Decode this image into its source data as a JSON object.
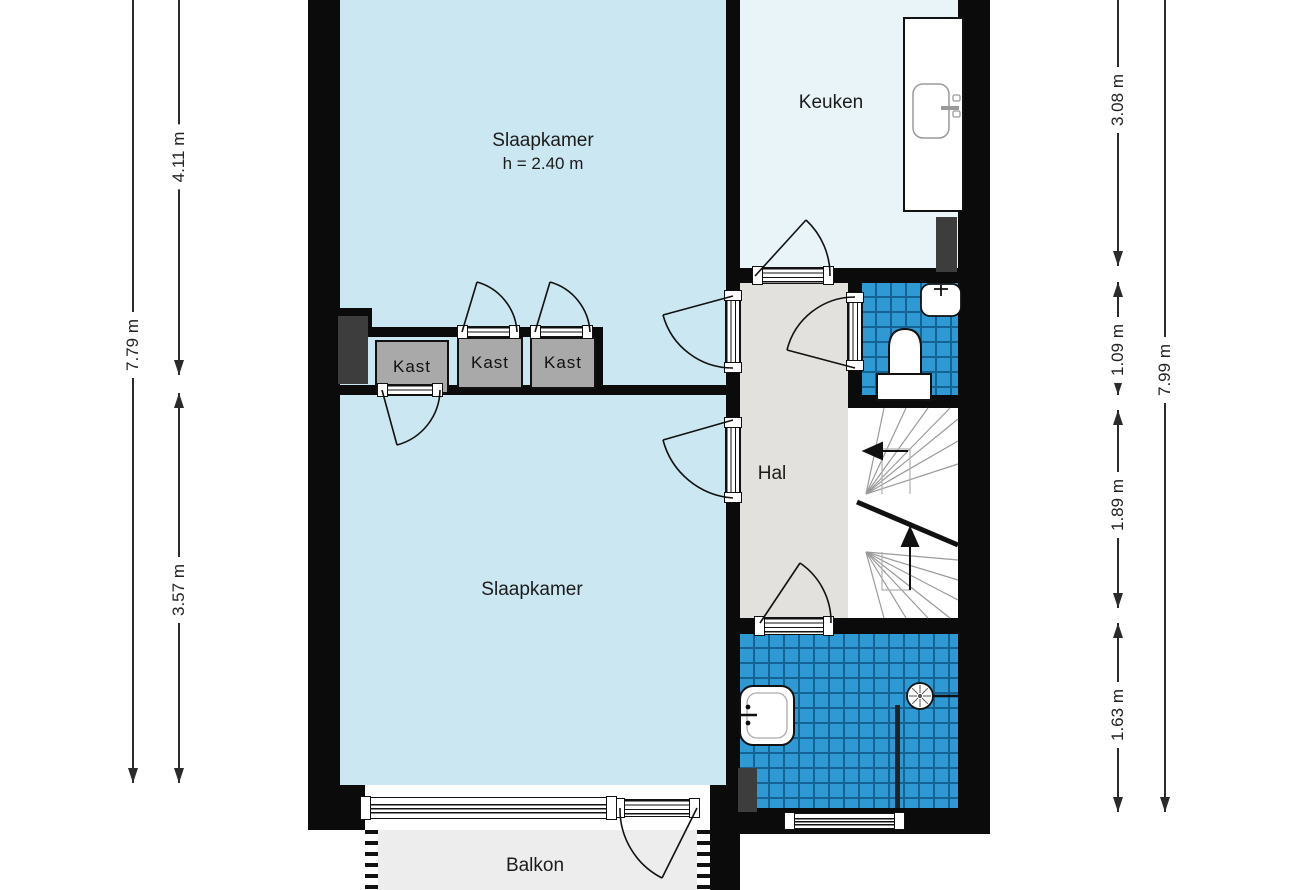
{
  "title": "Floor plan",
  "rooms": {
    "bedroom_top": {
      "label": "Slaapkamer",
      "height_note": "h = 2.40 m"
    },
    "kitchen": {
      "label": "Keuken"
    },
    "hall": {
      "label": "Hal"
    },
    "bedroom_bottom": {
      "label": "Slaapkamer"
    },
    "balcony": {
      "label": "Balkon"
    }
  },
  "closets": [
    {
      "label": "Kast"
    },
    {
      "label": "Kast"
    },
    {
      "label": "Kast"
    }
  ],
  "dimensions": {
    "left_total": "7.79 m",
    "left_upper": "4.11 m",
    "left_lower": "3.57 m",
    "right_kitchen": "3.08 m",
    "right_wc": "1.09 m",
    "right_stairs": "1.89 m",
    "right_bathroom": "1.63 m",
    "right_total": "7.99 m"
  },
  "fixtures": {
    "kitchen_sink": "kitchen-sink-icon",
    "wc_hand_basin": "hand-basin-icon",
    "toilet": "toilet-icon",
    "bathroom_sink": "washbasin-icon",
    "shower": "shower-head-icon",
    "stairs": "winder-stairs-icon"
  },
  "colors": {
    "wall": "#0b0b0b",
    "bedroom_floor": "#cbe7f1",
    "kitchen_floor": "#e9f4f9",
    "hall_floor": "#e3e1dd",
    "tile_floor": "#2e99d3",
    "tile_grid": "#156392",
    "closet_fill": "#a9a9a9",
    "shaft_fill": "#3d3d3d",
    "balcony_floor": "#ededed",
    "dimension": "#2b2b2b"
  }
}
